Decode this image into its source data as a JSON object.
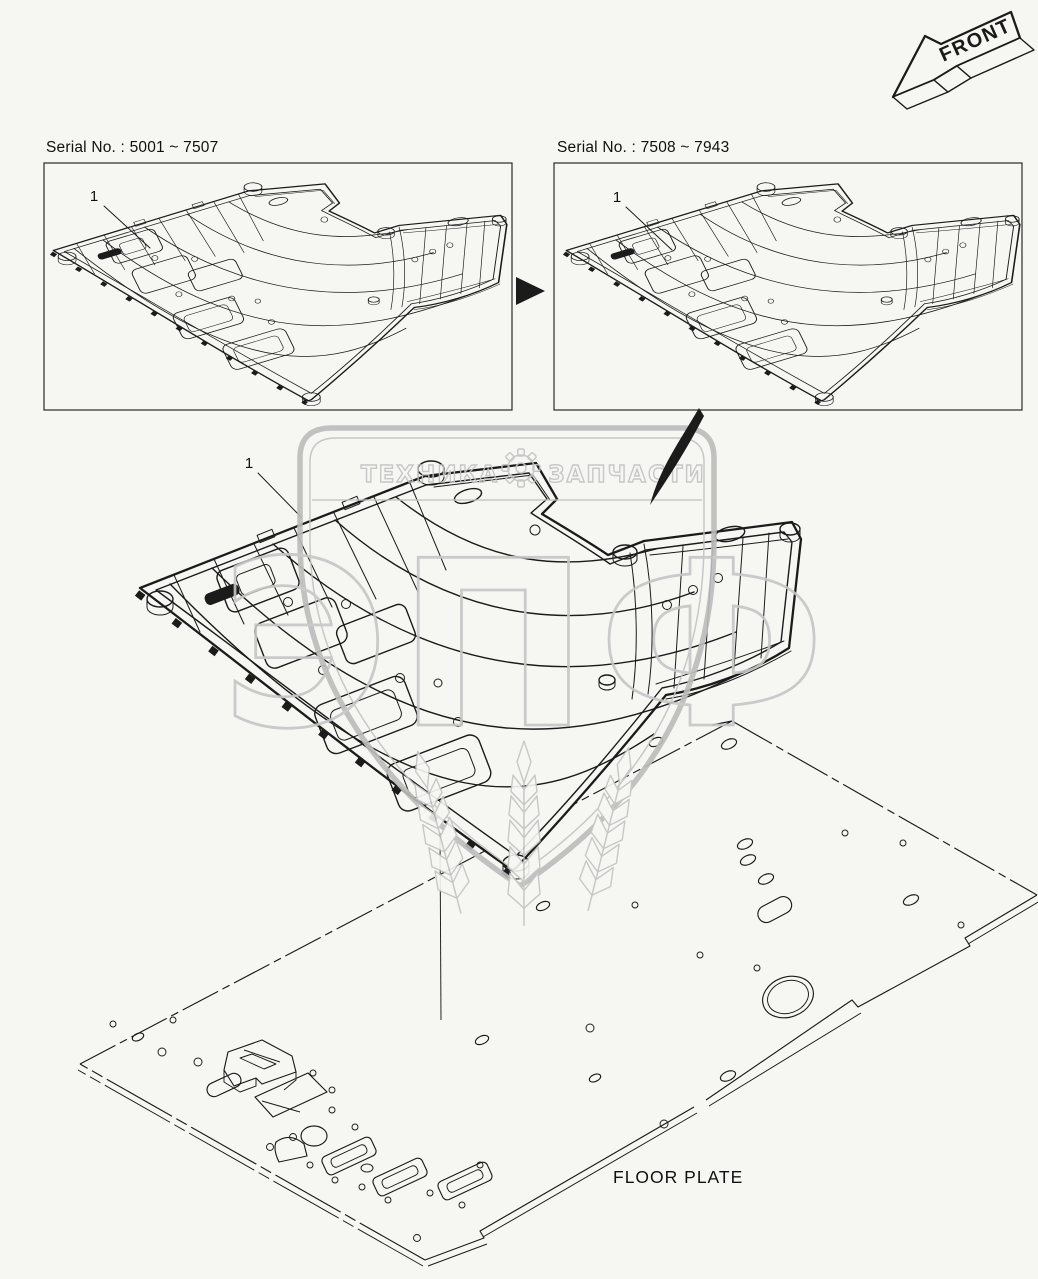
{
  "page": {
    "background": "#f6f6f3",
    "ink": "#1b1b1b",
    "watermark_gray": "#c3c3c3"
  },
  "front_arrow": {
    "label": "FRONT"
  },
  "panels": [
    {
      "serial_label": "Serial No.  : 5001 ~ 7507",
      "callout": "1"
    },
    {
      "serial_label": "Serial No.  : 7508 ~ 7943",
      "callout": "1"
    }
  ],
  "main_view": {
    "callout": "1"
  },
  "floor_plate": {
    "label": "FLOOR PLATE"
  },
  "watermark": {
    "word_left": "ТЕХНИКА",
    "word_right": "ЗАПЧАСТИ",
    "monogram": "ЭПФ"
  },
  "icons": {
    "front": "front-direction-arrow",
    "transition": "right-triangle-arrow",
    "flow": "curved-swoosh-arrow",
    "watermark_gear": "gear",
    "watermark_shield": "shield",
    "watermark_wheat": "wheat-ears"
  }
}
